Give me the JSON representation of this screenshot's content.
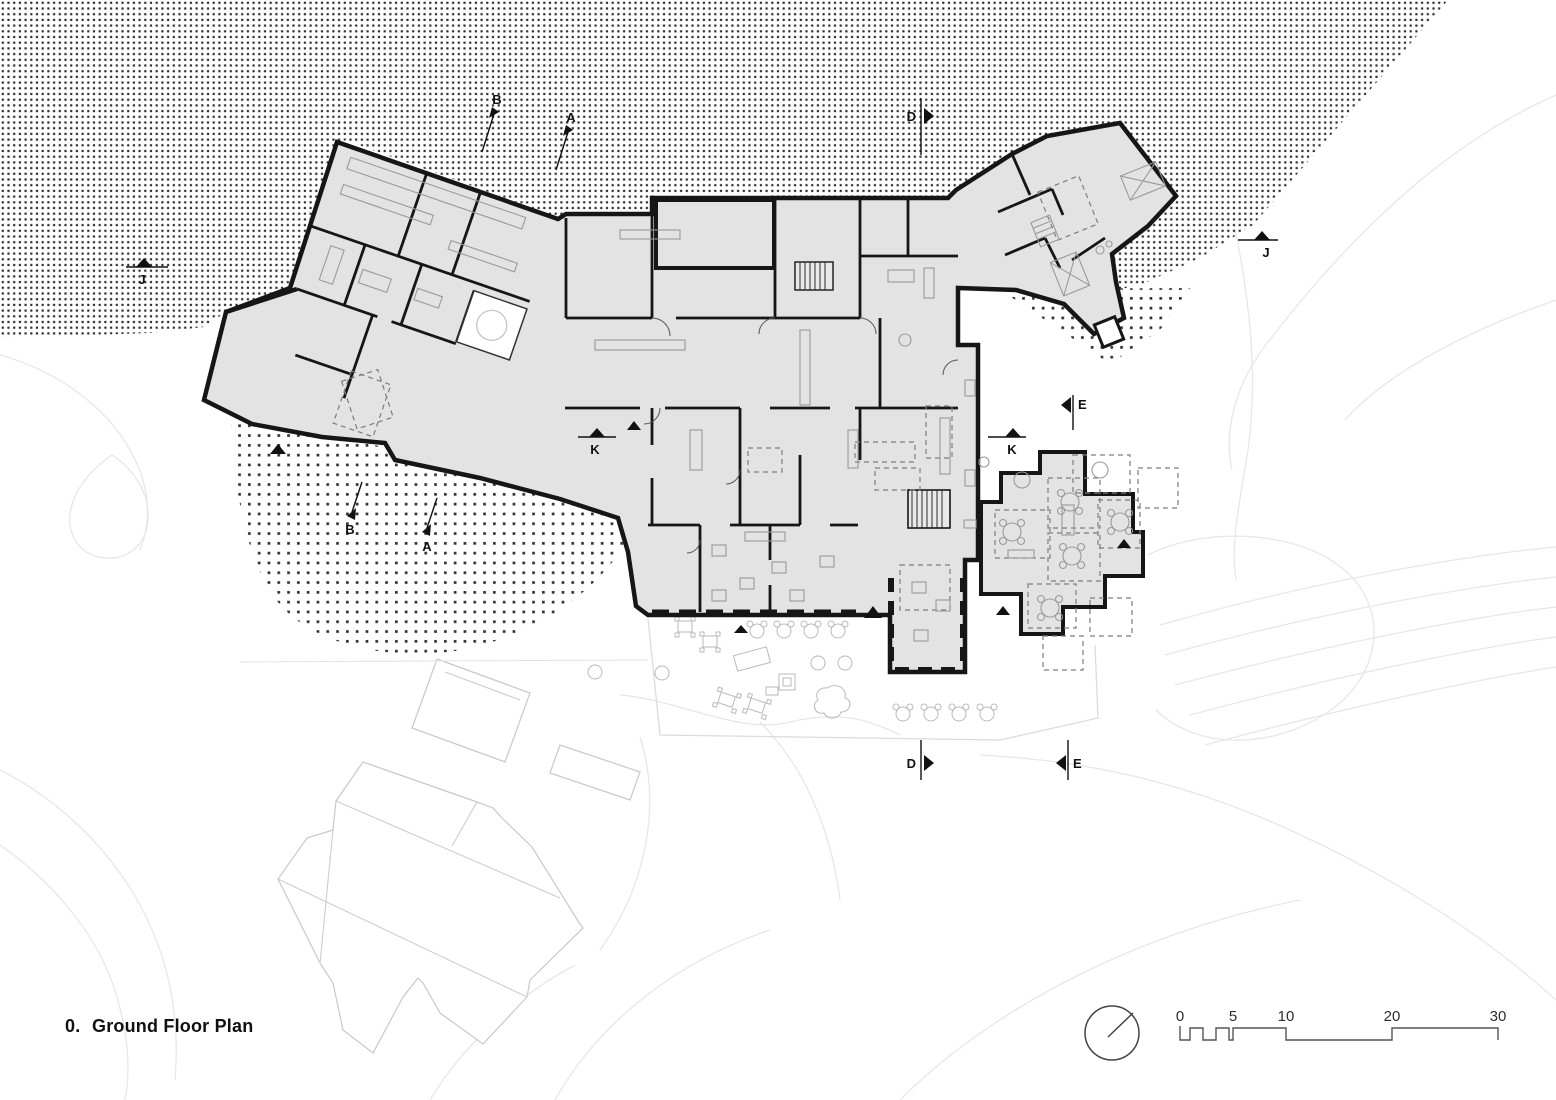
{
  "title": {
    "prefix": "0.",
    "text": "Ground Floor Plan"
  },
  "markers": {
    "A": "A",
    "B": "B",
    "D": "D",
    "E": "E",
    "J": "J",
    "K": "K"
  },
  "scale_bar": {
    "ticks": [
      "0",
      "5",
      "10",
      "20",
      "30"
    ]
  },
  "compass": {
    "icon": "north-arrow-circle"
  },
  "colors": {
    "building_fill": "#e3e3e3",
    "wall": "#161616",
    "halftone_dot": "#2e2e2e",
    "contour": "#e7e7e7",
    "neighbor_outline": "#c8c8c8",
    "background": "#ffffff"
  }
}
